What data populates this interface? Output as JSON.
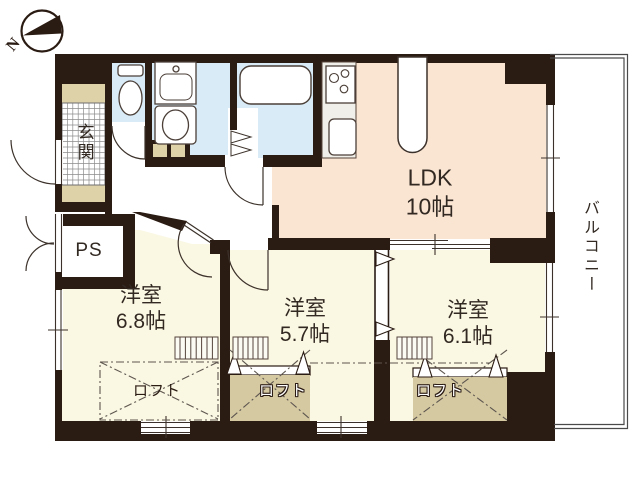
{
  "compass": {
    "north_label": "N"
  },
  "rooms": {
    "ldk": {
      "name": "LDK",
      "size": "10帖"
    },
    "western_room_1": {
      "name": "洋室",
      "size": "6.8帖"
    },
    "western_room_2": {
      "name": "洋室",
      "size": "5.7帖"
    },
    "western_room_3": {
      "name": "洋室",
      "size": "6.1帖"
    },
    "entrance": {
      "name": "玄関"
    },
    "pipe_space": {
      "name": "PS"
    },
    "balcony": {
      "name": "バルコニー"
    }
  },
  "lofts": {
    "loft_1": {
      "name": "ロフト"
    },
    "loft_2": {
      "name": "ロフト"
    },
    "loft_3": {
      "name": "ロフト"
    }
  },
  "colors": {
    "wall": "#2a1b13",
    "room_floor": "#faf7e2",
    "ldk_floor": "#fae5d3",
    "wet_area": "#d9ebf7",
    "tile_beige": "#ded2a8",
    "loft_tan": "#d5c9a2",
    "line": "#4b3f38"
  }
}
